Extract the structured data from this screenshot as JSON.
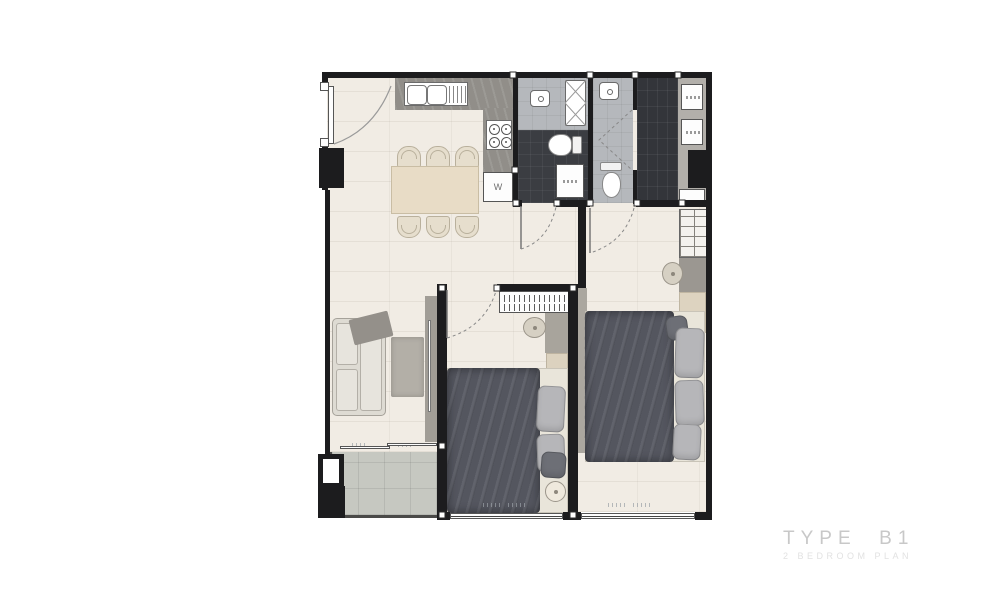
{
  "title": {
    "type_label": "TYPE  B1",
    "subtitle": "2 BEDROOM PLAN"
  },
  "labels": {
    "washer": "W"
  },
  "colors": {
    "wall": "#1c1c1e",
    "floor_main": "#f1ece4",
    "floor_bath": "#b5b8bc",
    "floor_bath_dark": "#3b3d42",
    "floor_closet_dark": "#33353a",
    "floor_balcony": "#c6c8c1",
    "counter": "#918e89",
    "table_wood": "#e8dcc6",
    "duvet": "#54565f",
    "pillow": "#b6b6b9",
    "title_text": "#c8c8c8"
  }
}
